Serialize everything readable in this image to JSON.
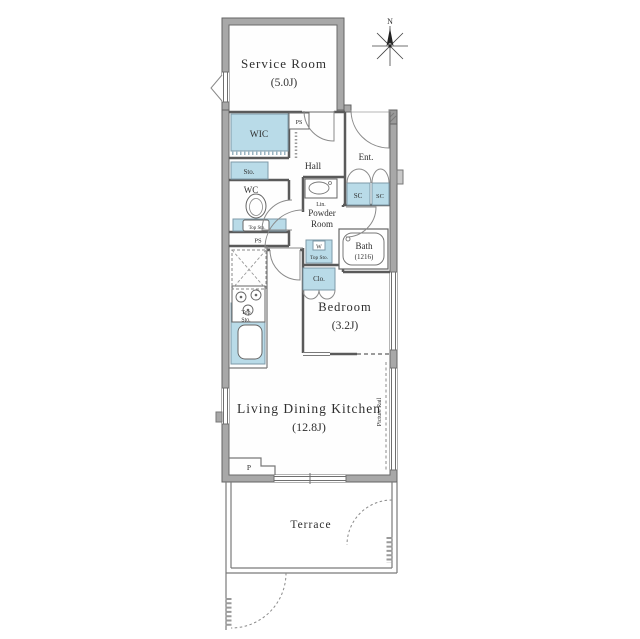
{
  "colors": {
    "storage_blue": "#b9dbe8",
    "wall_gray": "#a8a8a8",
    "line_dark": "#5a5a5a",
    "text": "#2f2f2f"
  },
  "compass": {
    "north_label": "N"
  },
  "rooms": {
    "service_room": {
      "name": "Service Room",
      "size": "(5.0J)"
    },
    "wic": {
      "label": "WIC"
    },
    "hall": {
      "label": "Hall"
    },
    "entrance": {
      "label": "Ent."
    },
    "wc": {
      "label": "WC"
    },
    "powder_room": {
      "line1": "Powder",
      "line2": "Room"
    },
    "bath": {
      "name": "Bath",
      "size": "(1216)"
    },
    "bedroom": {
      "name": "Bedroom",
      "size": "(3.2J)"
    },
    "ldk": {
      "name": "Living Dining Kitchen",
      "size": "(12.8J)"
    },
    "terrace": {
      "label": "Terrace"
    }
  },
  "storage": {
    "sto": "Sto.",
    "sc_left": "SC",
    "sc_right": "SC",
    "clo": "Clo.",
    "wc_top_sto": "Top Sto.",
    "washer_top_sto": "Top Sto.",
    "washer_mark": "W",
    "kitchen_top_sto_line1": "Top",
    "kitchen_top_sto_line2": "Sto."
  },
  "utilities": {
    "ps_upper": "PS",
    "ps_lower": "PS",
    "pillar": "P",
    "linen": "Lin.",
    "picture_rail": "Picture Rail"
  }
}
